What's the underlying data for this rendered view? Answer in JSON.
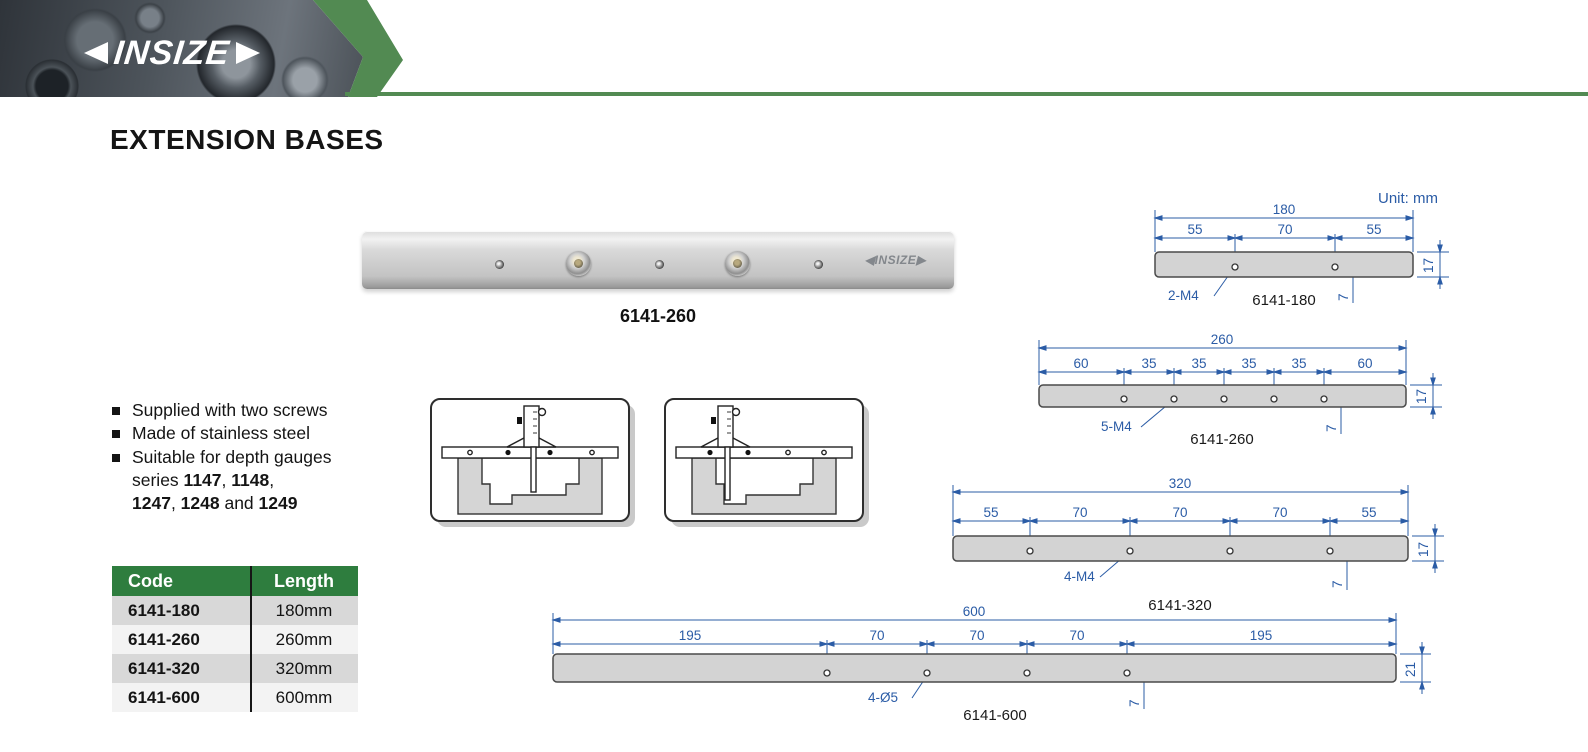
{
  "header": {
    "brand": "INSIZE"
  },
  "page": {
    "title": "EXTENSION BASES"
  },
  "product": {
    "caption": "6141-260",
    "etched_logo": "INSIZE"
  },
  "features": {
    "bullet1": "Supplied with two screws",
    "bullet2": "Made of stainless steel",
    "bullet3_line1": "Suitable for depth gauges",
    "bullet3_line2_prefix": "series ",
    "s1147": "1147",
    "sep1": ", ",
    "s1148": "1148",
    "sep2": ",",
    "s1247": "1247",
    "sep3": ", ",
    "s1248": "1248",
    "sep4": " and ",
    "s1249": "1249"
  },
  "table": {
    "headers": [
      "Code",
      "Length"
    ],
    "rows": [
      [
        "6141-180",
        "180mm"
      ],
      [
        "6141-260",
        "260mm"
      ],
      [
        "6141-320",
        "320mm"
      ],
      [
        "6141-600",
        "600mm"
      ]
    ]
  },
  "drawings": {
    "unit_label": "Unit: mm",
    "items": [
      {
        "caption": "6141-180",
        "total": "180",
        "segments": [
          "55",
          "70",
          "55"
        ],
        "hole_label": "2-M4",
        "height": "17",
        "hole_offset": "7"
      },
      {
        "caption": "6141-260",
        "total": "260",
        "segments": [
          "60",
          "35",
          "35",
          "35",
          "35",
          "60"
        ],
        "hole_label": "5-M4",
        "height": "17",
        "hole_offset": "7"
      },
      {
        "caption": "6141-320",
        "total": "320",
        "segments": [
          "55",
          "70",
          "70",
          "70",
          "55"
        ],
        "hole_label": "4-M4",
        "height": "17",
        "hole_offset": "7"
      },
      {
        "caption": "6141-600",
        "total": "600",
        "segments": [
          "195",
          "70",
          "70",
          "70",
          "195"
        ],
        "hole_label": "4-Ø5",
        "height": "21",
        "hole_offset": "7"
      }
    ]
  },
  "colors": {
    "accent_green": "#528a52",
    "table_header_green": "#2e7d3e",
    "dimension_blue": "#2b5ca6"
  }
}
